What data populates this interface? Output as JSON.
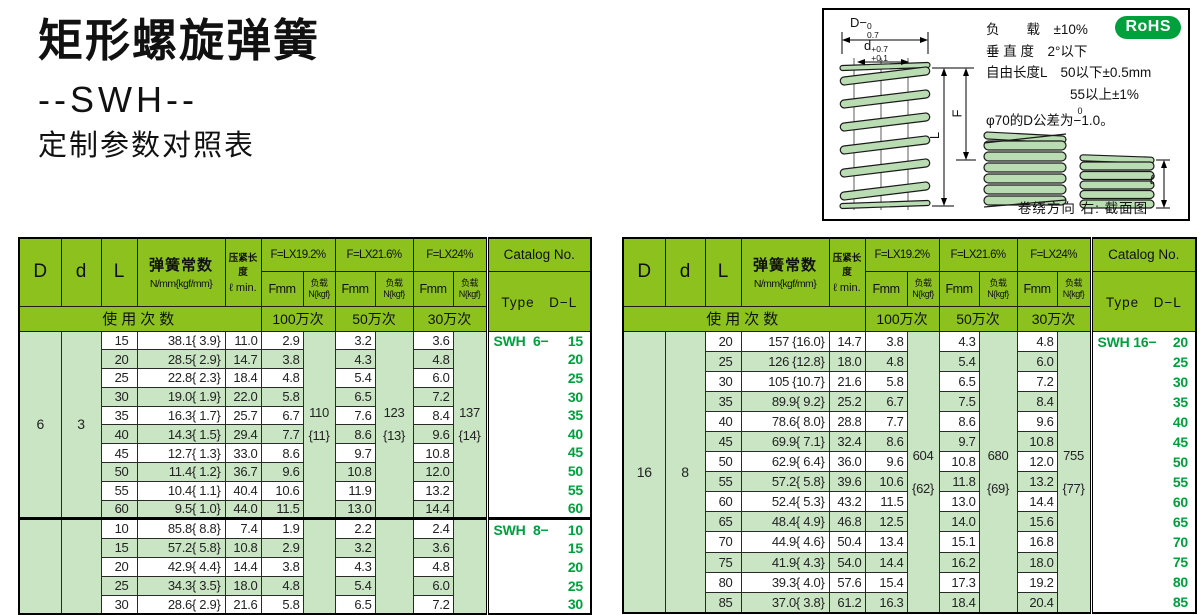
{
  "page": {
    "title": "矩形螺旋弹簧",
    "model": "--SWH--",
    "subtitle": "定制参数对照表"
  },
  "diagram": {
    "rohs": "RoHS",
    "specs": [
      "负　　载　±10%",
      "垂 直 度　2°以下",
      "自由长度L　50以下±0.5mm",
      "55以上±1%"
    ],
    "tol": {
      "pre": "φ70的D公差为",
      "sup": "0",
      "val": "−1.0",
      "post": "。"
    },
    "dims": {
      "D_base": "D−",
      "D_sup": "0",
      "D_sub": "0.7",
      "d_base": "d",
      "d_sup": "+0.7",
      "d_sub": "+0.1",
      "F": "F",
      "L": "L",
      "l": "ℓ"
    },
    "caption": "卷绕方向 右: 截面图"
  },
  "header": {
    "D": "D",
    "d": "d",
    "L": "L",
    "constant_title": "弹簧常数",
    "constant_unit": "N/mm{kgf/mm}",
    "press_title": "压紧长度",
    "press_unit": "ℓ min.",
    "f_groups": [
      {
        "label": "F=LX19.2%",
        "cycles": "100万次"
      },
      {
        "label": "F=LX21.6%",
        "cycles": "50万次"
      },
      {
        "label": "F=LX24%",
        "cycles": "30万次"
      }
    ],
    "fmm": "Fmm",
    "load_l1": "负载",
    "load_l2": "N{kgf}",
    "usage": "使用次数",
    "catalog_title": "Catalog No.",
    "catalog_sub": "Type　D−L"
  },
  "tables": [
    {
      "groups": [
        {
          "D": "6",
          "d": "3",
          "catalog_prefix": "SWH  6−",
          "loads": [
            {
              "n": "110",
              "kgf": "{11}"
            },
            {
              "n": "123",
              "kgf": "{13}"
            },
            {
              "n": "137",
              "kgf": "{14}"
            }
          ],
          "rows": [
            [
              "15",
              "38.1{ 3.9}",
              "11.0",
              "2.9",
              "3.2",
              "3.6"
            ],
            [
              "20",
              "28.5{ 2.9}",
              "14.7",
              "3.8",
              "4.3",
              "4.8"
            ],
            [
              "25",
              "22.8{ 2.3}",
              "18.4",
              "4.8",
              "5.4",
              "6.0"
            ],
            [
              "30",
              "19.0{ 1.9}",
              "22.0",
              "5.8",
              "6.5",
              "7.2"
            ],
            [
              "35",
              "16.3{ 1.7}",
              "25.7",
              "6.7",
              "7.6",
              "8.4"
            ],
            [
              "40",
              "14.3{ 1.5}",
              "29.4",
              "7.7",
              "8.6",
              "9.6"
            ],
            [
              "45",
              "12.7{ 1.3}",
              "33.0",
              "8.6",
              "9.7",
              "10.8"
            ],
            [
              "50",
              "11.4{ 1.2}",
              "36.7",
              "9.6",
              "10.8",
              "12.0"
            ],
            [
              "55",
              "10.4{ 1.1}",
              "40.4",
              "10.6",
              "11.9",
              "13.2"
            ],
            [
              "60",
              "9.5{ 1.0}",
              "44.0",
              "11.5",
              "13.0",
              "14.4"
            ]
          ]
        },
        {
          "D": "",
          "d": "",
          "catalog_prefix": "SWH  8−",
          "loads": [
            {
              "n": "",
              "kgf": ""
            },
            {
              "n": "",
              "kgf": ""
            },
            {
              "n": "",
              "kgf": ""
            }
          ],
          "rows": [
            [
              "10",
              "85.8{ 8.8}",
              "7.4",
              "1.9",
              "2.2",
              "2.4"
            ],
            [
              "15",
              "57.2{ 5.8}",
              "10.8",
              "2.9",
              "3.2",
              "3.6"
            ],
            [
              "20",
              "42.9{ 4.4}",
              "14.4",
              "3.8",
              "4.3",
              "4.8"
            ],
            [
              "25",
              "34.3{ 3.5}",
              "18.0",
              "4.8",
              "5.4",
              "6.0"
            ],
            [
              "30",
              "28.6{ 2.9}",
              "21.6",
              "5.8",
              "6.5",
              "7.2"
            ]
          ]
        }
      ]
    },
    {
      "groups": [
        {
          "D": "16",
          "d": "8",
          "catalog_prefix": "SWH 16−",
          "loads": [
            {
              "n": "604",
              "kgf": "{62}"
            },
            {
              "n": "680",
              "kgf": "{69}"
            },
            {
              "n": "755",
              "kgf": "{77}"
            }
          ],
          "rows": [
            [
              "20",
              "157 {16.0}",
              "14.7",
              "3.8",
              "4.3",
              "4.8"
            ],
            [
              "25",
              "126 {12.8}",
              "18.0",
              "4.8",
              "5.4",
              "6.0"
            ],
            [
              "30",
              "105 {10.7}",
              "21.6",
              "5.8",
              "6.5",
              "7.2"
            ],
            [
              "35",
              "89.9{ 9.2}",
              "25.2",
              "6.7",
              "7.5",
              "8.4"
            ],
            [
              "40",
              "78.6{ 8.0}",
              "28.8",
              "7.7",
              "8.6",
              "9.6"
            ],
            [
              "45",
              "69.9{ 7.1}",
              "32.4",
              "8.6",
              "9.7",
              "10.8"
            ],
            [
              "50",
              "62.9{ 6.4}",
              "36.0",
              "9.6",
              "10.8",
              "12.0"
            ],
            [
              "55",
              "57.2{ 5.8}",
              "39.6",
              "10.6",
              "11.8",
              "13.2"
            ],
            [
              "60",
              "52.4{ 5.3}",
              "43.2",
              "11.5",
              "13.0",
              "14.4"
            ],
            [
              "65",
              "48.4{ 4.9}",
              "46.8",
              "12.5",
              "14.0",
              "15.6"
            ],
            [
              "70",
              "44.9{ 4.6}",
              "50.4",
              "13.4",
              "15.1",
              "16.8"
            ],
            [
              "75",
              "41.9{ 4.3}",
              "54.0",
              "14.4",
              "16.2",
              "18.0"
            ],
            [
              "80",
              "39.3{ 4.0}",
              "57.6",
              "15.4",
              "17.3",
              "19.2"
            ],
            [
              "85",
              "37.0{ 3.8}",
              "61.2",
              "16.3",
              "18.4",
              "20.4"
            ]
          ]
        }
      ]
    }
  ]
}
